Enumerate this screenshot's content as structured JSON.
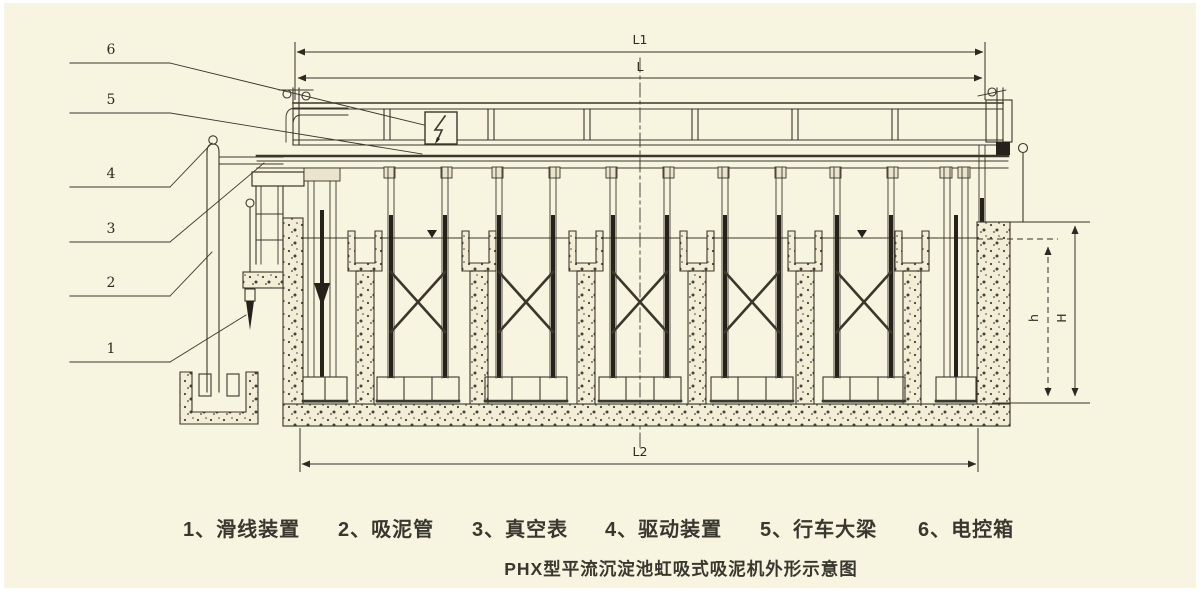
{
  "drawing": {
    "title": "PHX型平流沉淀池虹吸式吸泥机外形示意图",
    "dims": {
      "l1": "L1",
      "l": "L",
      "l2": "L2",
      "h": "h",
      "H": "H"
    },
    "callouts": [
      {
        "num": "6",
        "label": "电控箱"
      },
      {
        "num": "5",
        "label": "行车大梁"
      },
      {
        "num": "4",
        "label": "驱动装置"
      },
      {
        "num": "3",
        "label": "真空表"
      },
      {
        "num": "2",
        "label": "吸泥管"
      },
      {
        "num": "1",
        "label": "滑线装置"
      }
    ],
    "legend": [
      "1、滑线装置",
      "2、吸泥管",
      "3、真空表",
      "4、驱动装置",
      "5、行车大梁",
      "6、电控箱"
    ],
    "colors": {
      "paper": "#f7f4e0",
      "ink": "#3a372c",
      "dark_fill": "#24221b"
    }
  }
}
